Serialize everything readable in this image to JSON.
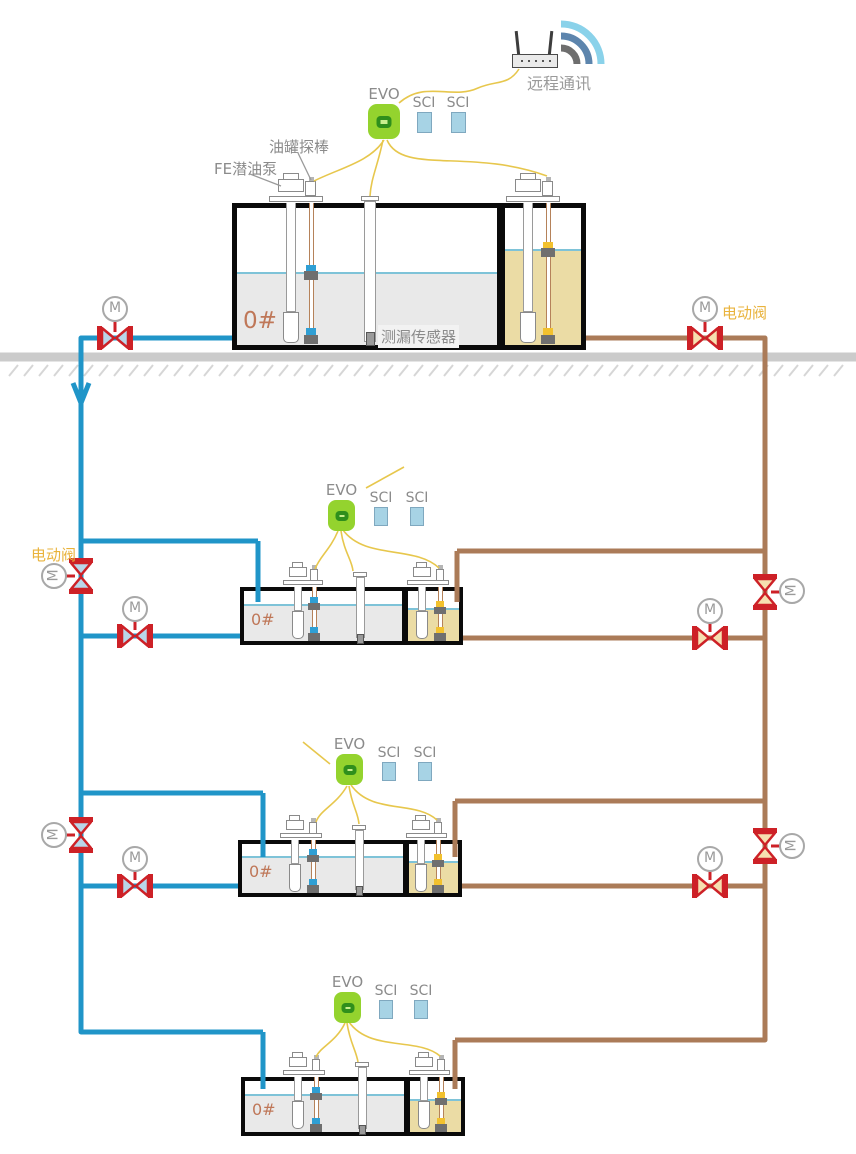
{
  "comm": {
    "label": "远程通讯"
  },
  "controller": {
    "evo": "EVO",
    "sci": "SCI"
  },
  "annotations": {
    "tank_probe": "油罐探棒",
    "fe_pump": "FE潜油泵",
    "leak_sensor": "测漏传感器",
    "electric_valve": "电动阀"
  },
  "valve": {
    "motor": "M"
  },
  "tanks": [
    {
      "grade": "0#"
    },
    {
      "grade": "0#"
    },
    {
      "grade": "0#"
    },
    {
      "grade": "0#"
    }
  ],
  "colors": {
    "pipe_supply_blue": "#2095c8",
    "pipe_return_brown": "#ab7b58",
    "signal_wire_yellow": "#e7c74d",
    "valve_red": "#cd2127",
    "valve_fill_blue": "#b9d6e9",
    "valve_fill_tan": "#f6e0b0",
    "evo_green": "#94d32e",
    "evo_inner_green": "#2f8f1c",
    "evo_core_green": "#c9ef8d",
    "sci_blue": "#a7d3e5",
    "liquid_gray": "#e9e9e9",
    "liquid_tan": "#ebdca5",
    "surface_blue": "#7ec3d8",
    "ground_gray": "#cbcbcb",
    "tank_outline": "#0a0a0a",
    "text_gray": "#8b8b8b",
    "grade_text": "#bf7758",
    "valve_label_orange": "#e9b33c",
    "wifi_outer": "#8ad2ea",
    "wifi_mid": "#5d85ad",
    "wifi_inner": "#6e6e6e"
  }
}
